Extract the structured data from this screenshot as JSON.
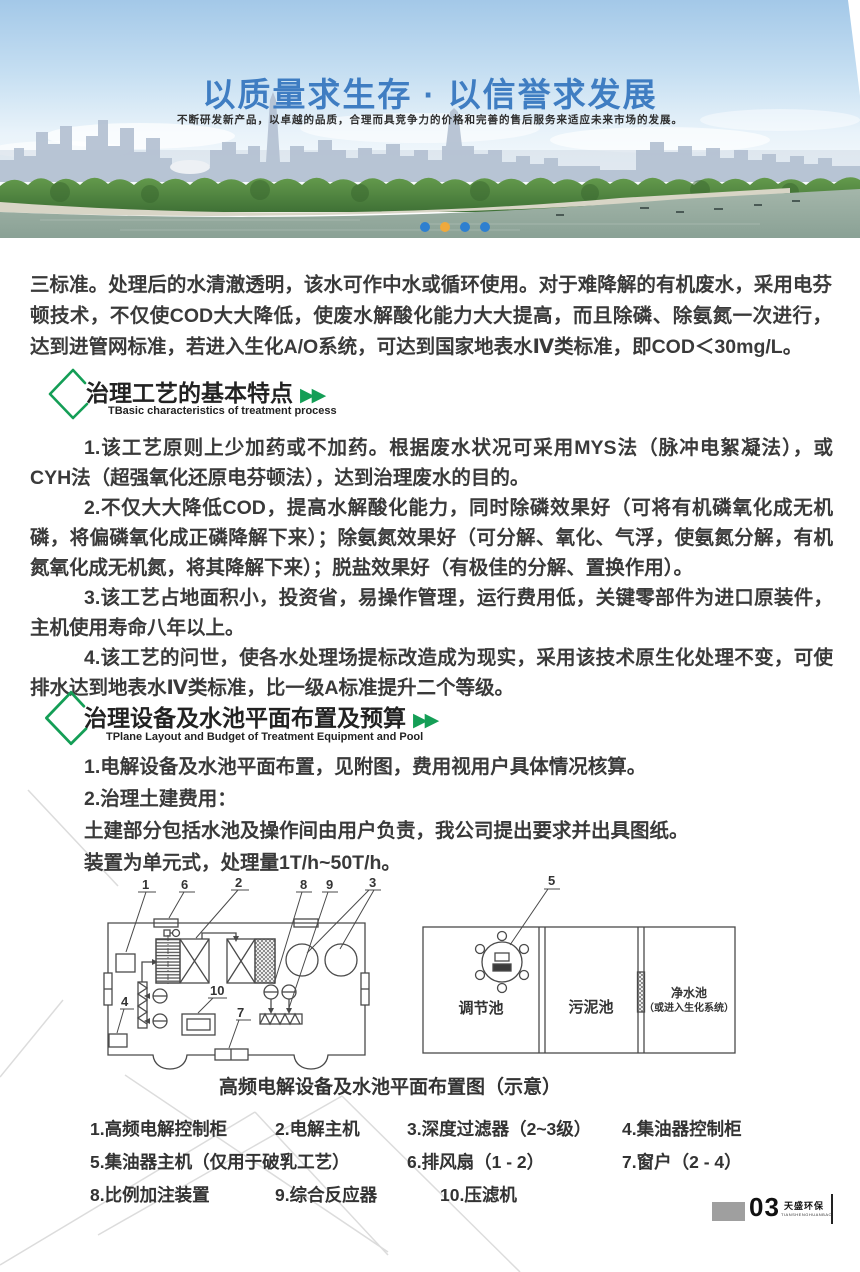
{
  "theme": {
    "green": "#149e56",
    "blue": "#3f7dc2",
    "dot_blue": "#2e7fd0",
    "dot_active": "#f0a93c",
    "text": "#3a3a3a",
    "line": "#4a4a4a",
    "watermark": "#dcdcdc",
    "footer_gray": "#9f9f9f"
  },
  "banner": {
    "title": "以质量求生存 · 以信誉求发展",
    "subtitle": "不断研发新产品，以卓越的品质，合理而具竞争力的价格和完善的售后服务来适应未来市场的发展。",
    "carousel": {
      "dot_count": 4,
      "active_index": 2
    }
  },
  "icons": {
    "double_arrow": "▶▶"
  },
  "intro": "三标准。处理后的水清澈透明，该水可作中水或循环使用。对于难降解的有机废水，采用电芬顿技术，不仅使COD大大降低，使废水解酸化能力大大提高，而且除磷、除氨氮一次进行，达到进管网标准，若进入生化A/O系统，可达到国家地表水Ⅳ类标准，即COD＜30mg/L。",
  "section1": {
    "title": "治理工艺的基本特点",
    "subtitle": "TBasic characteristics of treatment process",
    "paragraphs": [
      "1.该工艺原则上少加药或不加药。根据废水状况可采用MYS法（脉冲电絮凝法），或CYH法（超强氧化还原电芬顿法），达到治理废水的目的。",
      "2.不仅大大降低COD，提高水解酸化能力，同时除磷效果好（可将有机磷氧化成无机磷，将偏磷氧化成正磷降解下来）；除氨氮效果好（可分解、氧化、气浮，使氨氮分解，有机氮氧化成无机氮，将其降解下来）；脱盐效果好（有极佳的分解、置换作用）。",
      "3.该工艺占地面积小，投资省，易操作管理，运行费用低，关键零部件为进口原装件，主机使用寿命八年以上。",
      "4.该工艺的问世，使各水处理场提标改造成为现实，采用该技术原生化处理不变，可使排水达到地表水Ⅳ类标准，比一级A标准提升二个等级。"
    ]
  },
  "section2": {
    "title": "治理设备及水池平面布置及预算",
    "subtitle": "TPlane Layout and Budget of Treatment Equipment and Pool",
    "lines": [
      "1.电解设备及水池平面布置，见附图，费用视用户具体情况核算。",
      "2.治理土建费用：",
      "土建部分包括水池及操作间由用户负责，我公司提出要求并出具图纸。",
      "装置为单元式，处理量1T/h~50T/h。"
    ]
  },
  "diagram": {
    "left_callouts": [
      "1",
      "6",
      "2",
      "8",
      "9",
      "3",
      "4",
      "10",
      "7"
    ],
    "right_callout": "5",
    "pool1": "调节池",
    "pool2": "污泥池",
    "pool3_line1": "净水池",
    "pool3_line2": "（或进入生化系统）",
    "caption": "高频电解设备及水池平面布置图（示意）"
  },
  "legend": {
    "items": [
      "1.高频电解控制柜",
      "2.电解主机",
      "3.深度过滤器（2~3级）",
      "4.集油器控制柜",
      "5.集油器主机（仅用于破乳工艺）",
      "6.排风扇（1 - 2）",
      "7.窗户（2 - 4）",
      "8.比例加注装置",
      "9.综合反应器",
      "10.压滤机"
    ]
  },
  "footer": {
    "page_number": "03",
    "brand": "天盛环保",
    "brand_sub": "TIANSHENGHUANBAO"
  }
}
